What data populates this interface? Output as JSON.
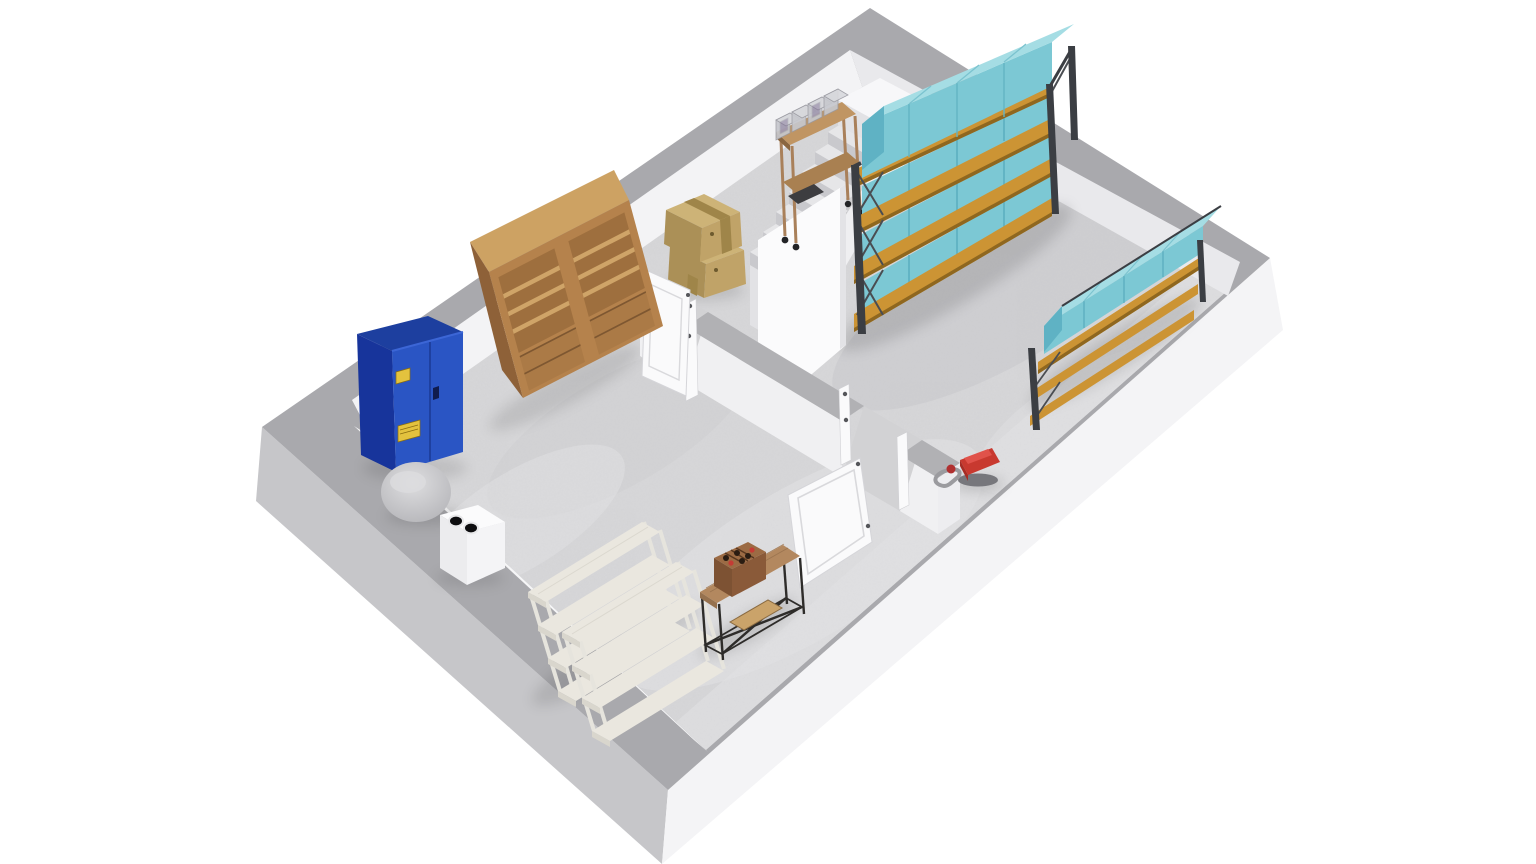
{
  "scene": {
    "type": "3d-floor-plan-render",
    "view": "isometric-dollhouse-cutaway",
    "rooms": 2,
    "stair_steps": 9,
    "rack_shelf_levels": 4,
    "teal_box_columns": 4,
    "storage_bins_on_cart": 4,
    "whitewashed_shelf_units": 2,
    "wine_bottle_red_caps": 2
  },
  "palette": {
    "background": "#ffffff",
    "wall_top": "#a9a9ad",
    "wall_outer_left": "#c6c6c9",
    "wall_outer_right": "#f4f4f6",
    "wall_inner": "#f3f3f5",
    "wall_inner_shaded": "#e9e9ec",
    "wall_inner_strip": "#f6f6f7",
    "divider_top": "#b1b1b4",
    "divider_face": "#f0f0f2",
    "divider_endcap": "#ededf0",
    "floor": "#d7d7d9",
    "floor_light": "#e4e4e6",
    "floor_dark": "#c3c3c7",
    "teal_top": "#a5dde4",
    "teal_front": "#7cc8d4",
    "teal_side": "#5fb2c4",
    "teal_line": "#58abbd",
    "wood_shelf": "#cc9434",
    "wood_shelf_dark": "#8f671f",
    "rack_frame": "#3b3e43",
    "bookshelf_front": "#b5824c",
    "bookshelf_side": "#8e6138",
    "bookshelf_top": "#cda263",
    "bookshelf_inner": "#9e6f3e",
    "bookshelf_shelf": "#cfa468",
    "bookshelf_drawer": "#ab7a46",
    "cabinet_front": "#2a55c4",
    "cabinet_side": "#17349b",
    "cabinet_top": "#1d3f9f",
    "hazard_yellow": "#e3c23e",
    "cardboard_top": "#cdb377",
    "cardboard_left": "#ab9057",
    "cardboard_right": "#c0a368",
    "cardboard_tape": "#9f8549",
    "whitewash_top": "#eae7df",
    "whitewash_edge": "#d9d6cd",
    "whitewash_post": "#f3f2ee",
    "console_wood": "#b3885f",
    "frame_black": "#2e2c2a",
    "crate_wood": "#9c6b44",
    "crate_dark": "#58371f",
    "bottle_red": "#c43c35",
    "vacuum_red": "#c8392f",
    "hose_gray": "#9b9b9f",
    "door_white": "#fafafb",
    "door_line": "#d9d9dc",
    "stair_tread": "#e6e6e8",
    "stair_riser": "#c9c9cd",
    "stair_side": "#efeff1",
    "balustrade": "#fbfbfc",
    "landing_top": "#f7f7f9",
    "landing_left": "#e2e2e5",
    "landing_right": "#efeff2",
    "dome_gray": "#c6c6c9",
    "sink_white": "#fbfbfc",
    "sink_side": "#ececee",
    "bin_fill": "#d8d9dd",
    "bin_front": "#c6c7cd",
    "bin_edge": "#9b9ba2",
    "cart_wood": "#c09563"
  },
  "objects": [
    {
      "name": "hazmat-storage-cabinet",
      "color": "#2a55c4"
    },
    {
      "name": "wooden-double-bookcase",
      "color": "#b5824c"
    },
    {
      "name": "water-tank-dome",
      "color": "#c6c6c9"
    },
    {
      "name": "utility-sink-unit",
      "color": "#fbfbfc"
    },
    {
      "name": "whitewashed-shelving-unit-1",
      "color": "#eae7df"
    },
    {
      "name": "whitewashed-shelving-unit-2",
      "color": "#eae7df"
    },
    {
      "name": "console-table-with-wine-crate",
      "color": "#b3885f"
    },
    {
      "name": "cardboard-box-stack",
      "color": "#cdb377"
    },
    {
      "name": "interior-door-upper",
      "color": "#fafafb"
    },
    {
      "name": "interior-door-lower",
      "color": "#fafafb"
    },
    {
      "name": "staircase",
      "color": "#e6e6e8"
    },
    {
      "name": "stair-balustrade-wall",
      "color": "#fbfbfc"
    },
    {
      "name": "landing-platform",
      "color": "#f7f7f9"
    },
    {
      "name": "utility-cart-with-bins",
      "color": "#c09563"
    },
    {
      "name": "pallet-rack-large-with-teal-boxes",
      "color": "#7cc8d4"
    },
    {
      "name": "low-rack-along-right-wall",
      "color": "#7cc8d4"
    },
    {
      "name": "vacuum-cleaner",
      "color": "#c8392f"
    }
  ]
}
